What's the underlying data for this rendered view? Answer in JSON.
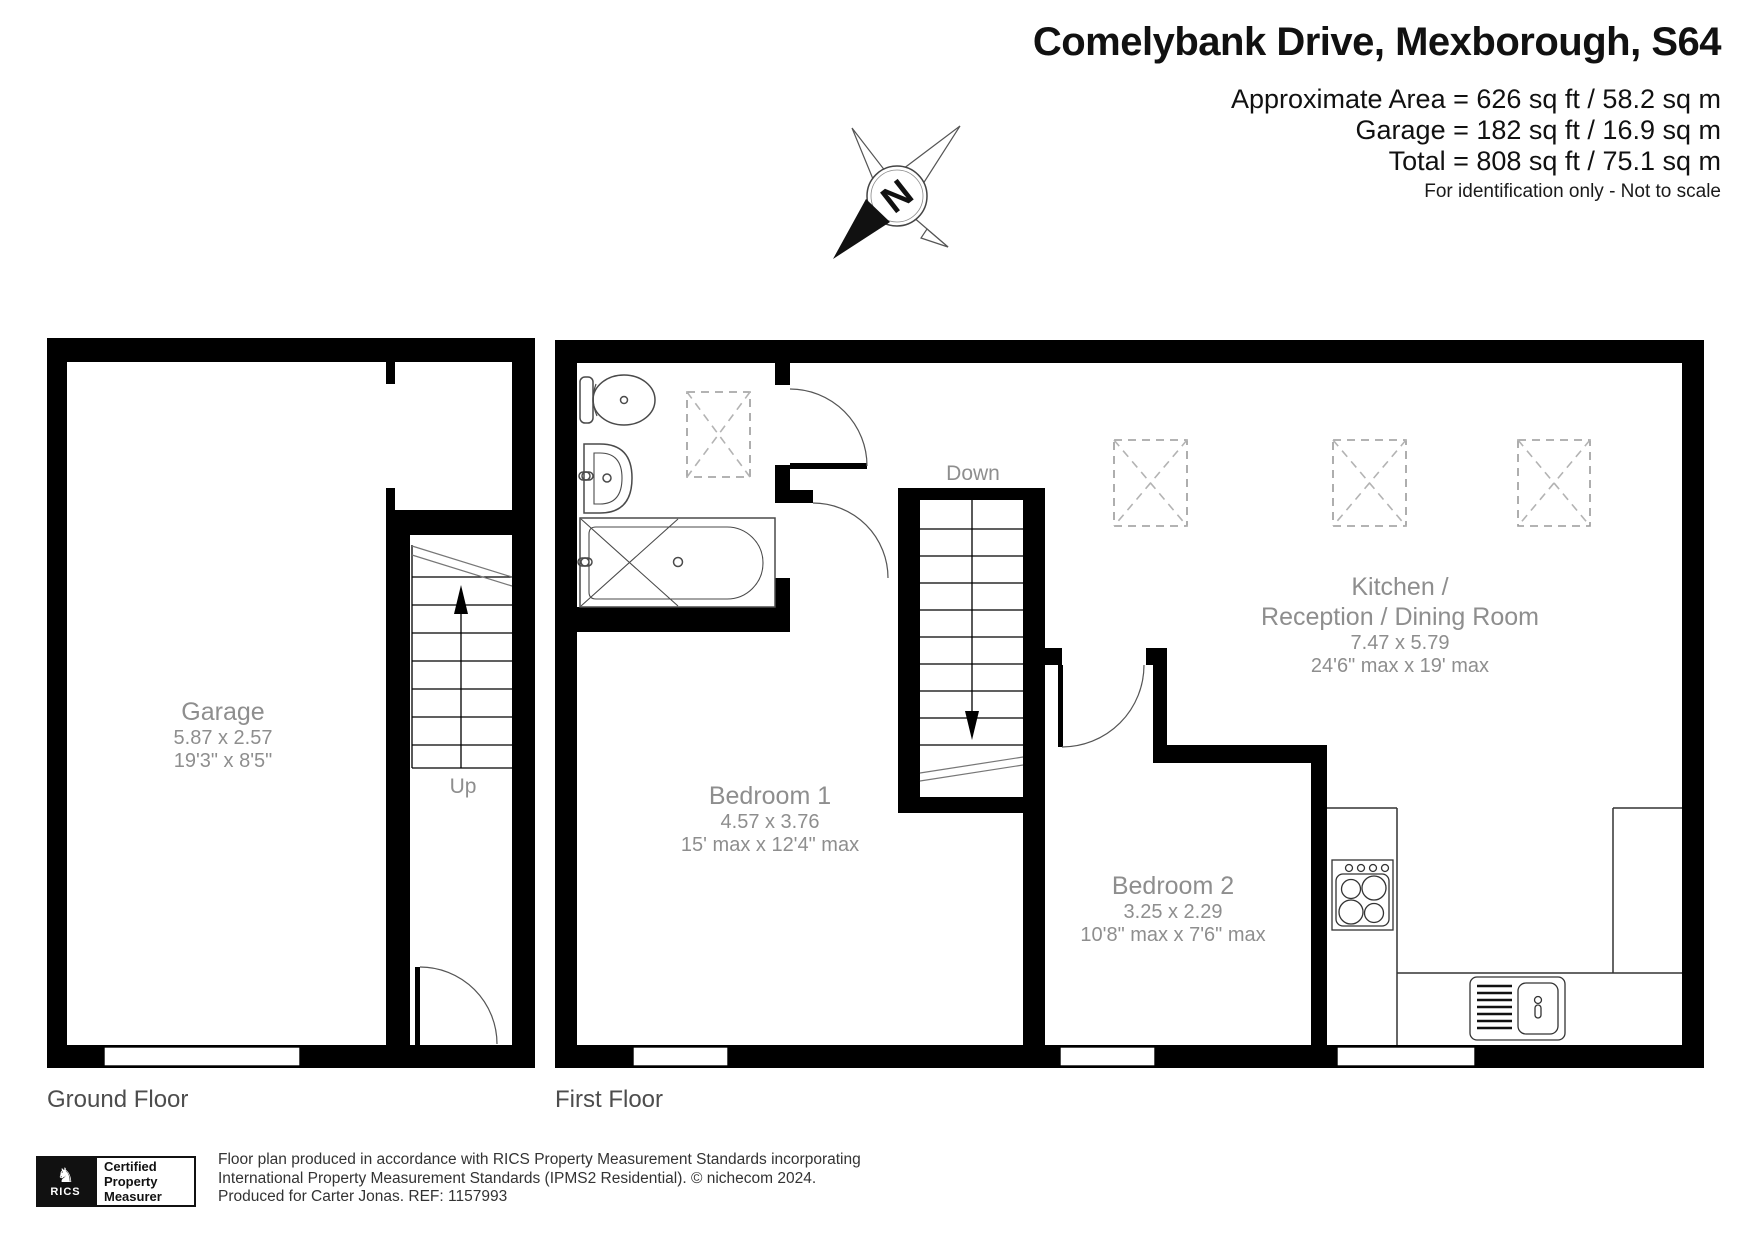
{
  "header": {
    "title": "Comelybank Drive, Mexborough, S64",
    "area_lines": [
      "Approximate Area = 626 sq ft / 58.2 sq m",
      "Garage = 182 sq ft / 16.9 sq m",
      "Total = 808 sq ft / 75.1 sq m"
    ],
    "disclaimer": "For identification only - Not to scale"
  },
  "compass": {
    "label": "N"
  },
  "floors": [
    {
      "label": "Ground Floor",
      "stair_direction": "Up",
      "rooms": [
        {
          "name": "Garage",
          "dims_metric": "5.87 x 2.57",
          "dims_imperial": "19'3\" x 8'5\""
        }
      ]
    },
    {
      "label": "First Floor",
      "stair_direction": "Down",
      "rooms": [
        {
          "name": "Bedroom 1",
          "dims_metric": "4.57 x 3.76",
          "dims_imperial": "15' max x 12'4\" max"
        },
        {
          "name": "Bedroom 2",
          "dims_metric": "3.25 x 2.29",
          "dims_imperial": "10'8\" max x 7'6\" max"
        },
        {
          "name_lines": [
            "Kitchen /",
            "Reception / Dining Room"
          ],
          "dims_metric": "7.47 x 5.79",
          "dims_imperial": "24'6\" max x 19' max"
        }
      ]
    }
  ],
  "footer": {
    "credit_lines": [
      "Floor plan produced in accordance with RICS Property Measurement Standards incorporating",
      "International Property Measurement Standards (IPMS2 Residential).    © nichecom 2024.",
      "Produced for Carter Jonas.   REF:  1157993"
    ],
    "rics_badge": {
      "brand": "RICS",
      "certification": [
        "Certified",
        "Property",
        "Measurer"
      ]
    }
  },
  "colors": {
    "walls": "#000000",
    "room_label": "#8e8e8e",
    "floor_label": "#4d4d4d",
    "skylight_dash": "#9a9a9a"
  }
}
